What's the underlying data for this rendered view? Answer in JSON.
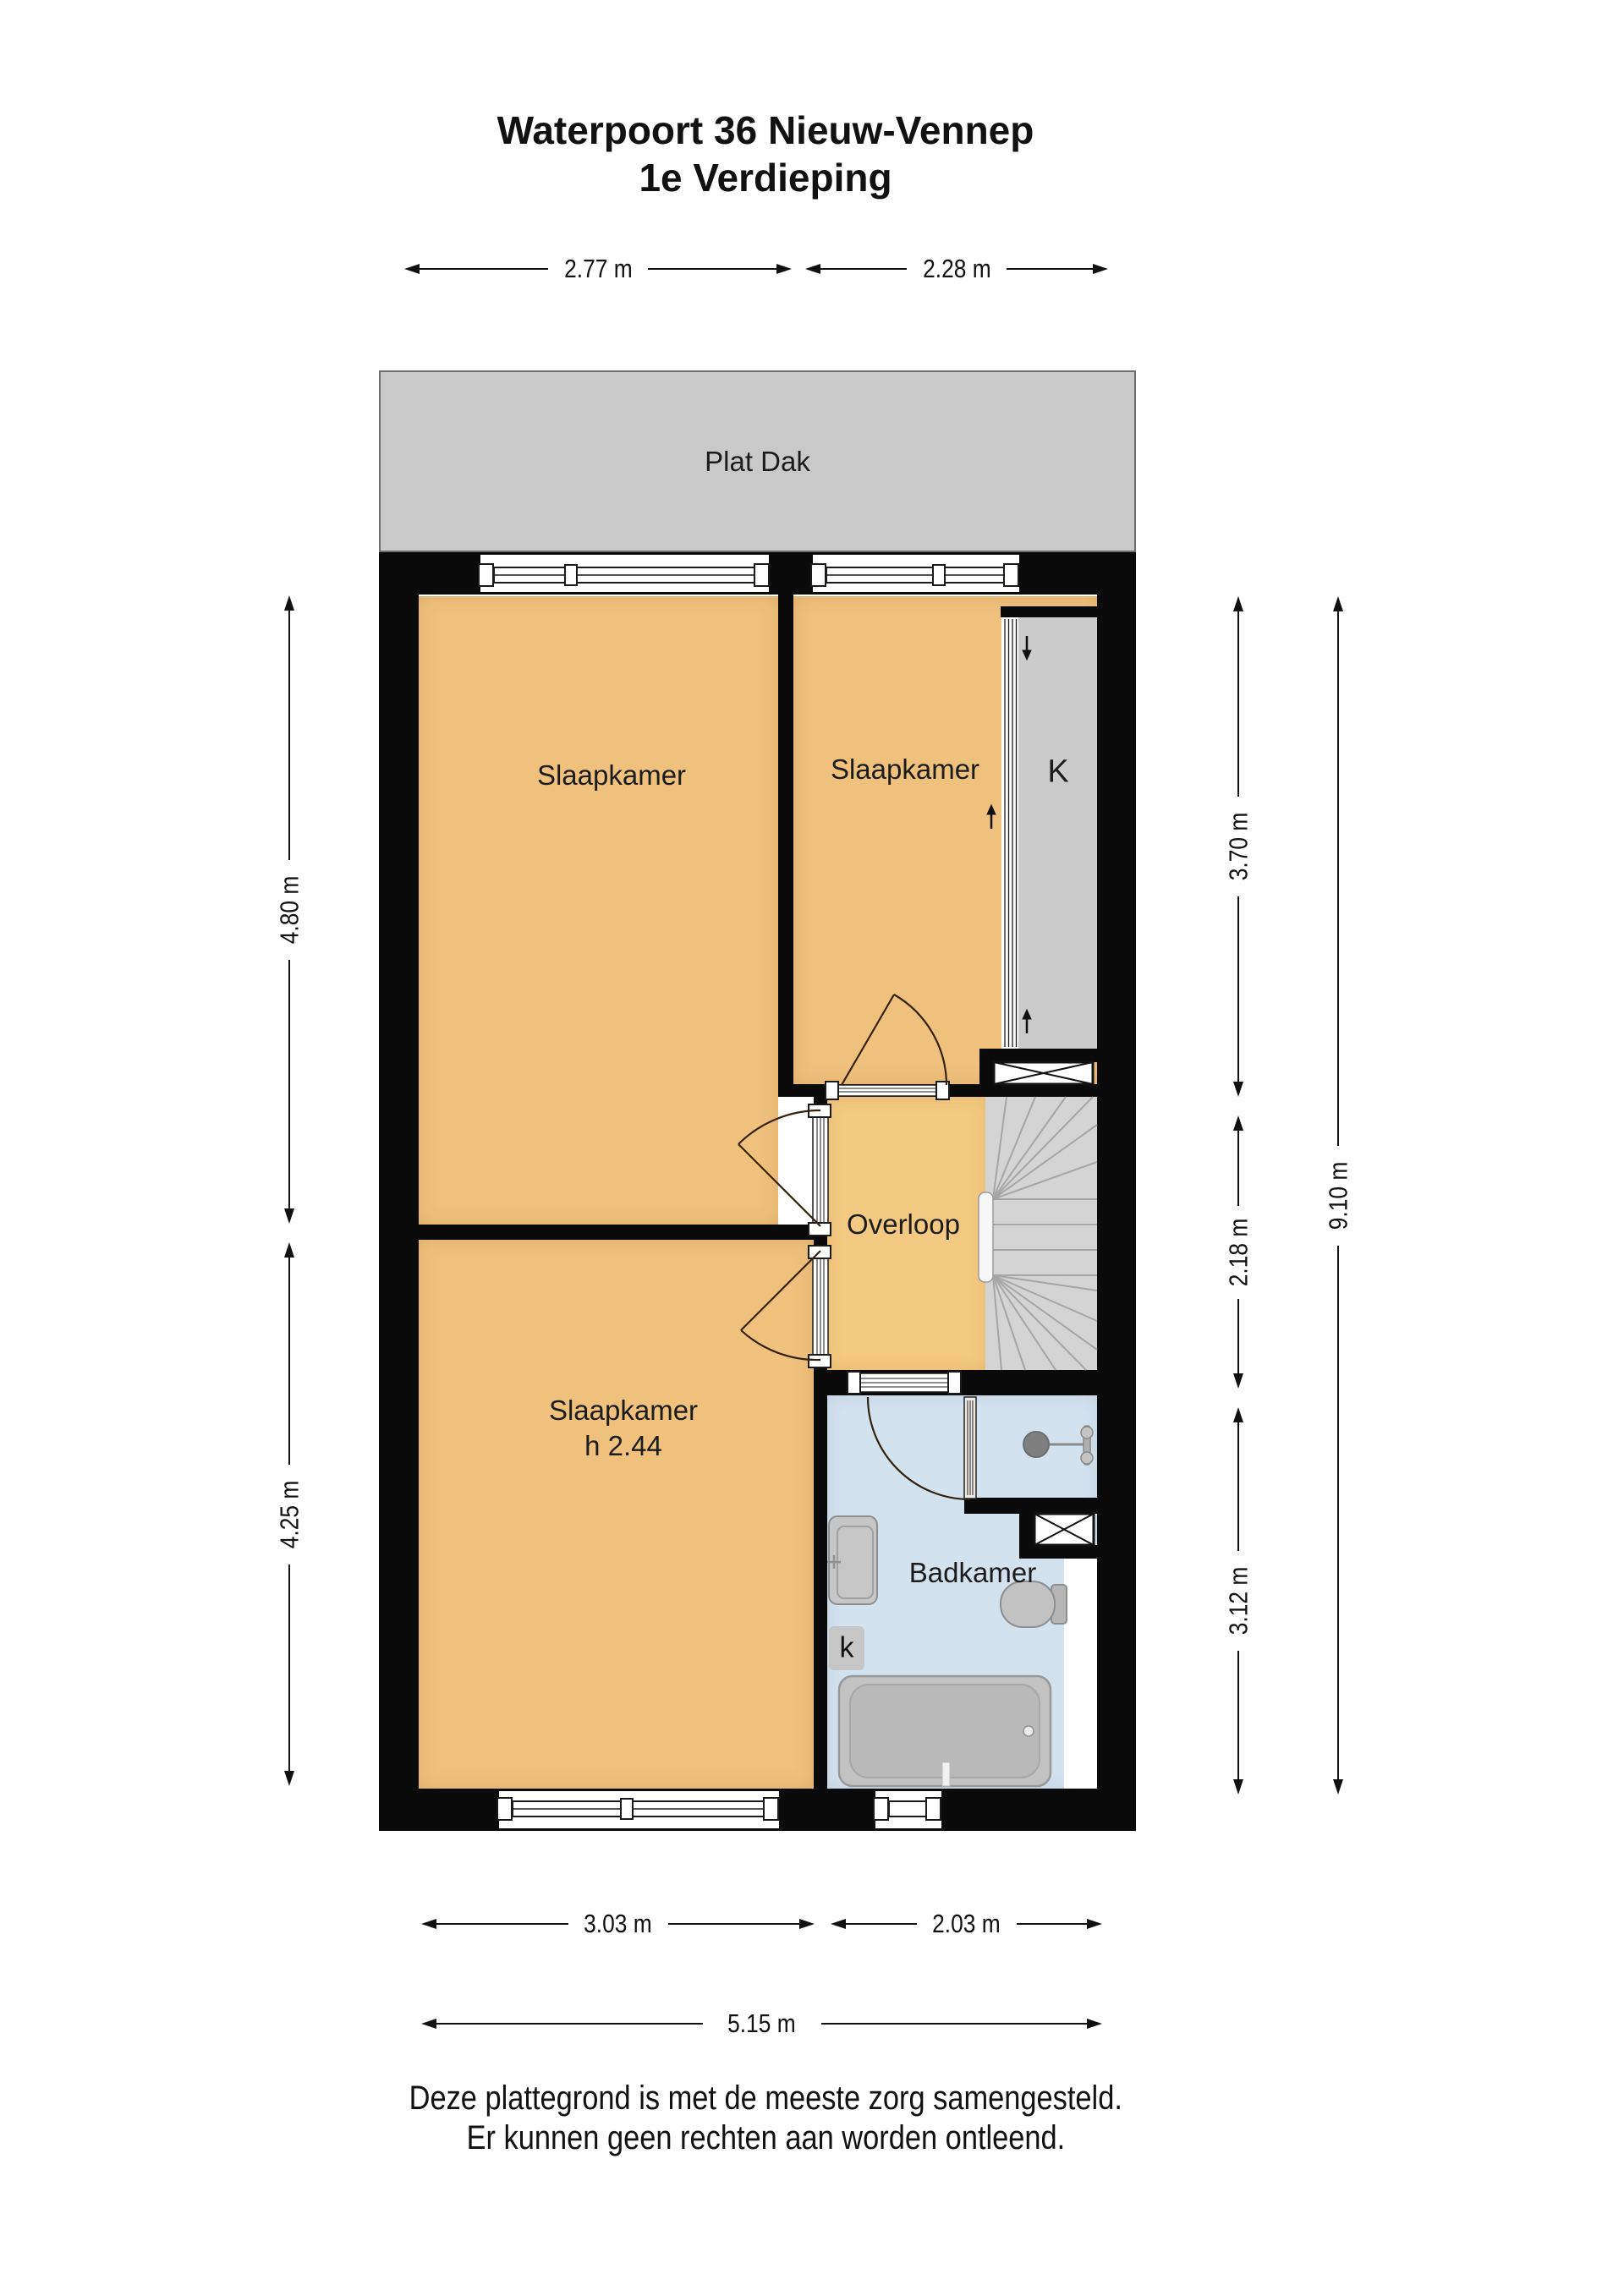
{
  "title": {
    "line1": "Waterpoort 36 Nieuw-Vennep",
    "line2": "1e Verdieping"
  },
  "rooms": {
    "flat_roof": "Plat Dak",
    "bedroom_top_left": "Slaapkamer",
    "bedroom_top_right": "Slaapkamer",
    "bedroom_bottom": "Slaapkamer",
    "bedroom_bottom_height": "h 2.44",
    "landing": "Overloop",
    "bathroom": "Badkamer",
    "closet": "K",
    "cabinet": "k"
  },
  "dimensions": {
    "top_left": "2.77 m",
    "top_right": "2.28 m",
    "left_upper": "4.80 m",
    "left_lower": "4.25 m",
    "right_upper": "3.70 m",
    "right_middle": "2.18 m",
    "right_lower": "3.12 m",
    "right_total": "9.10 m",
    "bottom_left": "3.03 m",
    "bottom_right": "2.03 m",
    "bottom_total": "5.15 m"
  },
  "footer": {
    "line1": "Deze plattegrond is met de meeste zorg samengesteld.",
    "line2": "Er kunnen geen rechten aan worden ontleend."
  },
  "colors": {
    "wall": "#0a0a0a",
    "room_orange": "#efc17d",
    "landing_orange": "#f4c981",
    "bath_blue": "#d3e2ef",
    "closet_gray": "#cbcbcb",
    "stairs_gray": "#d4d4d4",
    "flat_roof_gray": "#c9c9c9"
  }
}
